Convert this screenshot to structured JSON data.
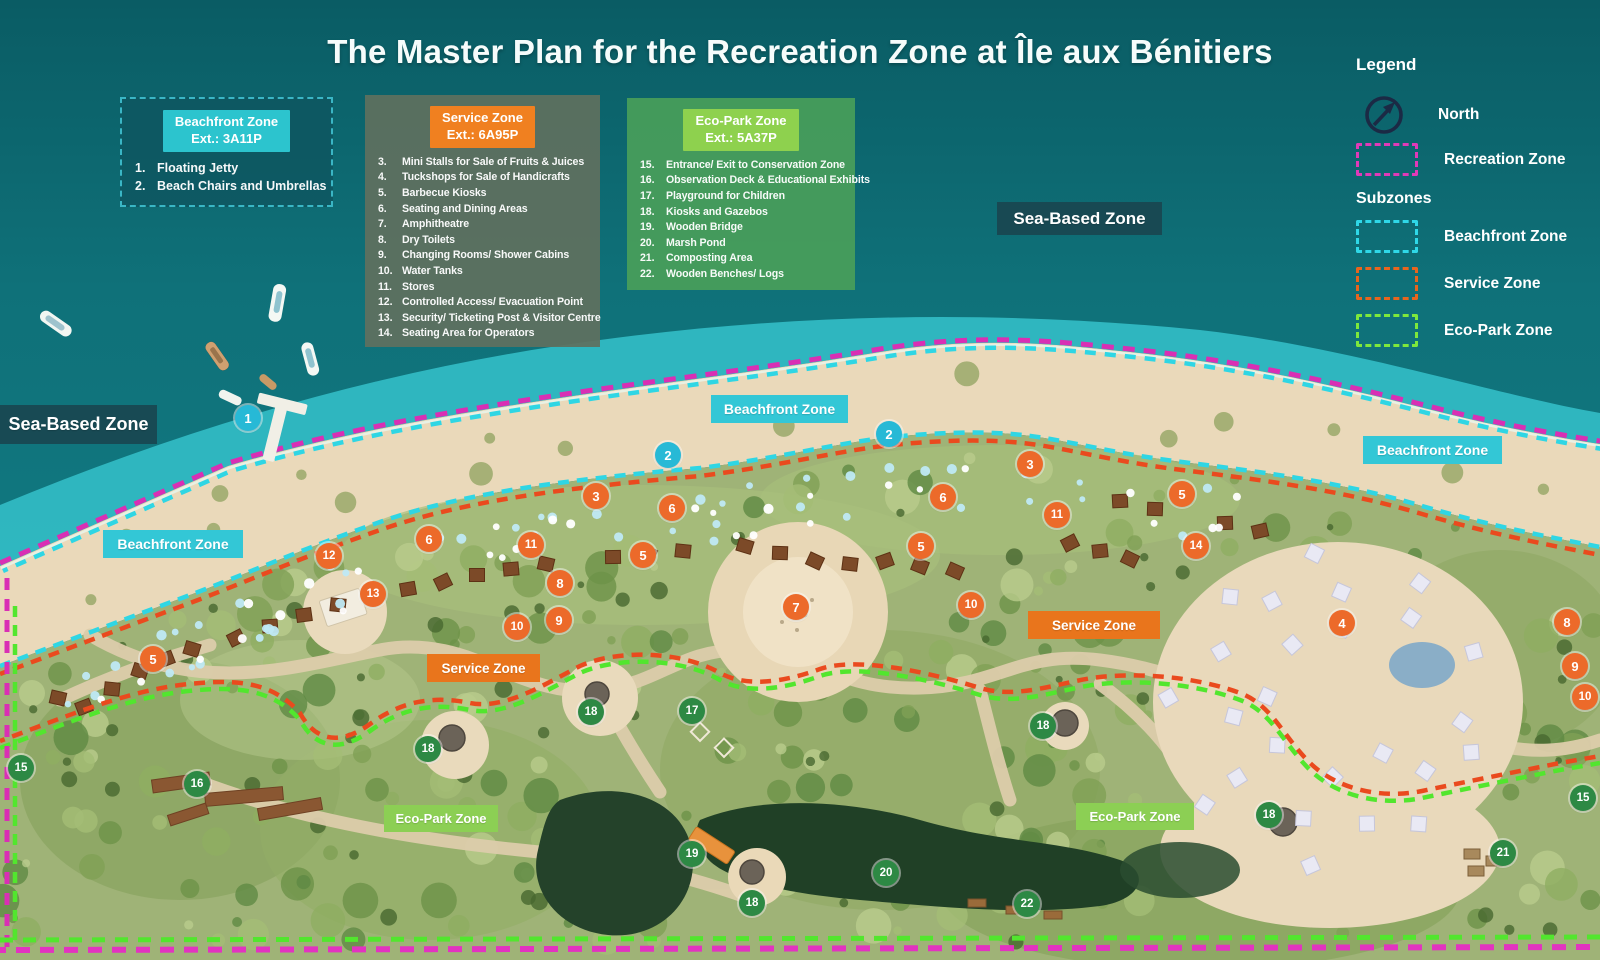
{
  "title": "The Master Plan for the Recreation Zone at Île aux Bénitiers",
  "zone_cards": [
    {
      "header_line1": "Beachfront Zone",
      "header_line2": "Ext.: 3A11P",
      "header_color": "#2cc4ce",
      "items": [
        {
          "num": "1.",
          "label": "Floating Jetty"
        },
        {
          "num": "2.",
          "label": "Beach Chairs and Umbrellas"
        }
      ]
    },
    {
      "header_line1": "Service Zone",
      "header_line2": "Ext.: 6A95P",
      "header_color": "#f08020",
      "items": [
        {
          "num": "3.",
          "label": "Mini Stalls for Sale of Fruits & Juices"
        },
        {
          "num": "4.",
          "label": "Tuckshops for Sale of Handicrafts"
        },
        {
          "num": "5.",
          "label": "Barbecue Kiosks"
        },
        {
          "num": "6.",
          "label": "Seating and Dining Areas"
        },
        {
          "num": "7.",
          "label": "Amphitheatre"
        },
        {
          "num": "8.",
          "label": "Dry Toilets"
        },
        {
          "num": "9.",
          "label": "Changing Rooms/ Shower Cabins"
        },
        {
          "num": "10.",
          "label": "Water Tanks"
        },
        {
          "num": "11.",
          "label": "Stores"
        },
        {
          "num": "12.",
          "label": "Controlled Access/ Evacuation Point"
        },
        {
          "num": "13.",
          "label": "Security/ Ticketing Post & Visitor Centre"
        },
        {
          "num": "14.",
          "label": "Seating Area for Operators"
        }
      ]
    },
    {
      "header_line1": "Eco-Park Zone",
      "header_line2": "Ext.: 5A37P",
      "header_color": "#8ed14e",
      "items": [
        {
          "num": "15.",
          "label": "Entrance/ Exit to Conservation Zone"
        },
        {
          "num": "16.",
          "label": "Observation Deck & Educational Exhibits"
        },
        {
          "num": "17.",
          "label": "Playground for Children"
        },
        {
          "num": "18.",
          "label": "Kiosks and Gazebos"
        },
        {
          "num": "19.",
          "label": "Wooden Bridge"
        },
        {
          "num": "20.",
          "label": "Marsh Pond"
        },
        {
          "num": "21.",
          "label": "Composting Area"
        },
        {
          "num": "22.",
          "label": "Wooden Benches/ Logs"
        }
      ]
    }
  ],
  "legend": {
    "title": "Legend",
    "north_label": "North",
    "north_color": "#1b2a45",
    "recreation_label": "Recreation Zone",
    "recreation_color": "#e03ab8",
    "subzones_title": "Subzones",
    "subzones": [
      {
        "label": "Beachfront Zone",
        "color": "#2fd8e8"
      },
      {
        "label": "Service Zone",
        "color": "#e8651e"
      },
      {
        "label": "Eco-Park Zone",
        "color": "#7ee83c"
      }
    ]
  },
  "label_colors": {
    "sea": "rgba(25,70,80,0.92)",
    "beachfront": "#33c7d6",
    "service": "#e9751c",
    "ecopark": "#8ccf54"
  },
  "marker_colors": {
    "beachfront": "#27b9d6",
    "service": "#ec6a2a",
    "ecopark": "#2d8944"
  },
  "map_labels": [
    {
      "text": "Sea-Based Zone",
      "type": "sea",
      "x": 0,
      "y": 405,
      "w": 157,
      "h": 39,
      "fs": 18
    },
    {
      "text": "Sea-Based Zone",
      "type": "sea",
      "x": 997,
      "y": 202,
      "w": 165,
      "h": 33,
      "fs": 17
    },
    {
      "text": "Beachfront Zone",
      "type": "beachfront",
      "x": 711,
      "y": 395,
      "w": 137,
      "h": 28,
      "fs": 14
    },
    {
      "text": "Beachfront Zone",
      "type": "beachfront",
      "x": 1363,
      "y": 436,
      "w": 139,
      "h": 28,
      "fs": 14
    },
    {
      "text": "Beachfront Zone",
      "type": "beachfront",
      "x": 103,
      "y": 530,
      "w": 140,
      "h": 28,
      "fs": 14
    },
    {
      "text": "Service Zone",
      "type": "service",
      "x": 427,
      "y": 654,
      "w": 113,
      "h": 28,
      "fs": 13.5
    },
    {
      "text": "Service Zone",
      "type": "service",
      "x": 1028,
      "y": 611,
      "w": 132,
      "h": 28,
      "fs": 13.5
    },
    {
      "text": "Eco-Park Zone",
      "type": "ecopark",
      "x": 384,
      "y": 805,
      "w": 114,
      "h": 27,
      "fs": 13
    },
    {
      "text": "Eco-Park Zone",
      "type": "ecopark",
      "x": 1076,
      "y": 803,
      "w": 118,
      "h": 27,
      "fs": 13
    }
  ],
  "markers": [
    {
      "n": 1,
      "zone": "beachfront",
      "x": 248,
      "y": 418
    },
    {
      "n": 2,
      "zone": "beachfront",
      "x": 668,
      "y": 455
    },
    {
      "n": 2,
      "zone": "beachfront",
      "x": 889,
      "y": 434
    },
    {
      "n": 3,
      "zone": "service",
      "x": 596,
      "y": 496
    },
    {
      "n": 3,
      "zone": "service",
      "x": 1030,
      "y": 464
    },
    {
      "n": 4,
      "zone": "service",
      "x": 1342,
      "y": 623
    },
    {
      "n": 5,
      "zone": "service",
      "x": 153,
      "y": 659
    },
    {
      "n": 5,
      "zone": "service",
      "x": 643,
      "y": 555
    },
    {
      "n": 5,
      "zone": "service",
      "x": 921,
      "y": 546
    },
    {
      "n": 5,
      "zone": "service",
      "x": 1182,
      "y": 494
    },
    {
      "n": 6,
      "zone": "service",
      "x": 429,
      "y": 539
    },
    {
      "n": 6,
      "zone": "service",
      "x": 672,
      "y": 508
    },
    {
      "n": 6,
      "zone": "service",
      "x": 943,
      "y": 497
    },
    {
      "n": 7,
      "zone": "service",
      "x": 796,
      "y": 607
    },
    {
      "n": 8,
      "zone": "service",
      "x": 560,
      "y": 583
    },
    {
      "n": 8,
      "zone": "service",
      "x": 1567,
      "y": 622
    },
    {
      "n": 9,
      "zone": "service",
      "x": 559,
      "y": 620
    },
    {
      "n": 9,
      "zone": "service",
      "x": 1575,
      "y": 666
    },
    {
      "n": 10,
      "zone": "service",
      "x": 517,
      "y": 627
    },
    {
      "n": 10,
      "zone": "service",
      "x": 971,
      "y": 605
    },
    {
      "n": 10,
      "zone": "service",
      "x": 1585,
      "y": 697
    },
    {
      "n": 11,
      "zone": "service",
      "x": 531,
      "y": 545
    },
    {
      "n": 11,
      "zone": "service",
      "x": 1057,
      "y": 515
    },
    {
      "n": 12,
      "zone": "service",
      "x": 329,
      "y": 556
    },
    {
      "n": 13,
      "zone": "service",
      "x": 373,
      "y": 594
    },
    {
      "n": 14,
      "zone": "service",
      "x": 1196,
      "y": 546
    },
    {
      "n": 15,
      "zone": "ecopark",
      "x": 21,
      "y": 768
    },
    {
      "n": 15,
      "zone": "ecopark",
      "x": 1583,
      "y": 798
    },
    {
      "n": 16,
      "zone": "ecopark",
      "x": 197,
      "y": 784
    },
    {
      "n": 17,
      "zone": "ecopark",
      "x": 692,
      "y": 711
    },
    {
      "n": 18,
      "zone": "ecopark",
      "x": 428,
      "y": 749
    },
    {
      "n": 18,
      "zone": "ecopark",
      "x": 591,
      "y": 712
    },
    {
      "n": 18,
      "zone": "ecopark",
      "x": 752,
      "y": 903
    },
    {
      "n": 18,
      "zone": "ecopark",
      "x": 1043,
      "y": 726
    },
    {
      "n": 18,
      "zone": "ecopark",
      "x": 1269,
      "y": 815
    },
    {
      "n": 19,
      "zone": "ecopark",
      "x": 692,
      "y": 854
    },
    {
      "n": 20,
      "zone": "ecopark",
      "x": 886,
      "y": 873
    },
    {
      "n": 21,
      "zone": "ecopark",
      "x": 1503,
      "y": 853
    },
    {
      "n": 22,
      "zone": "ecopark",
      "x": 1027,
      "y": 904
    }
  ]
}
